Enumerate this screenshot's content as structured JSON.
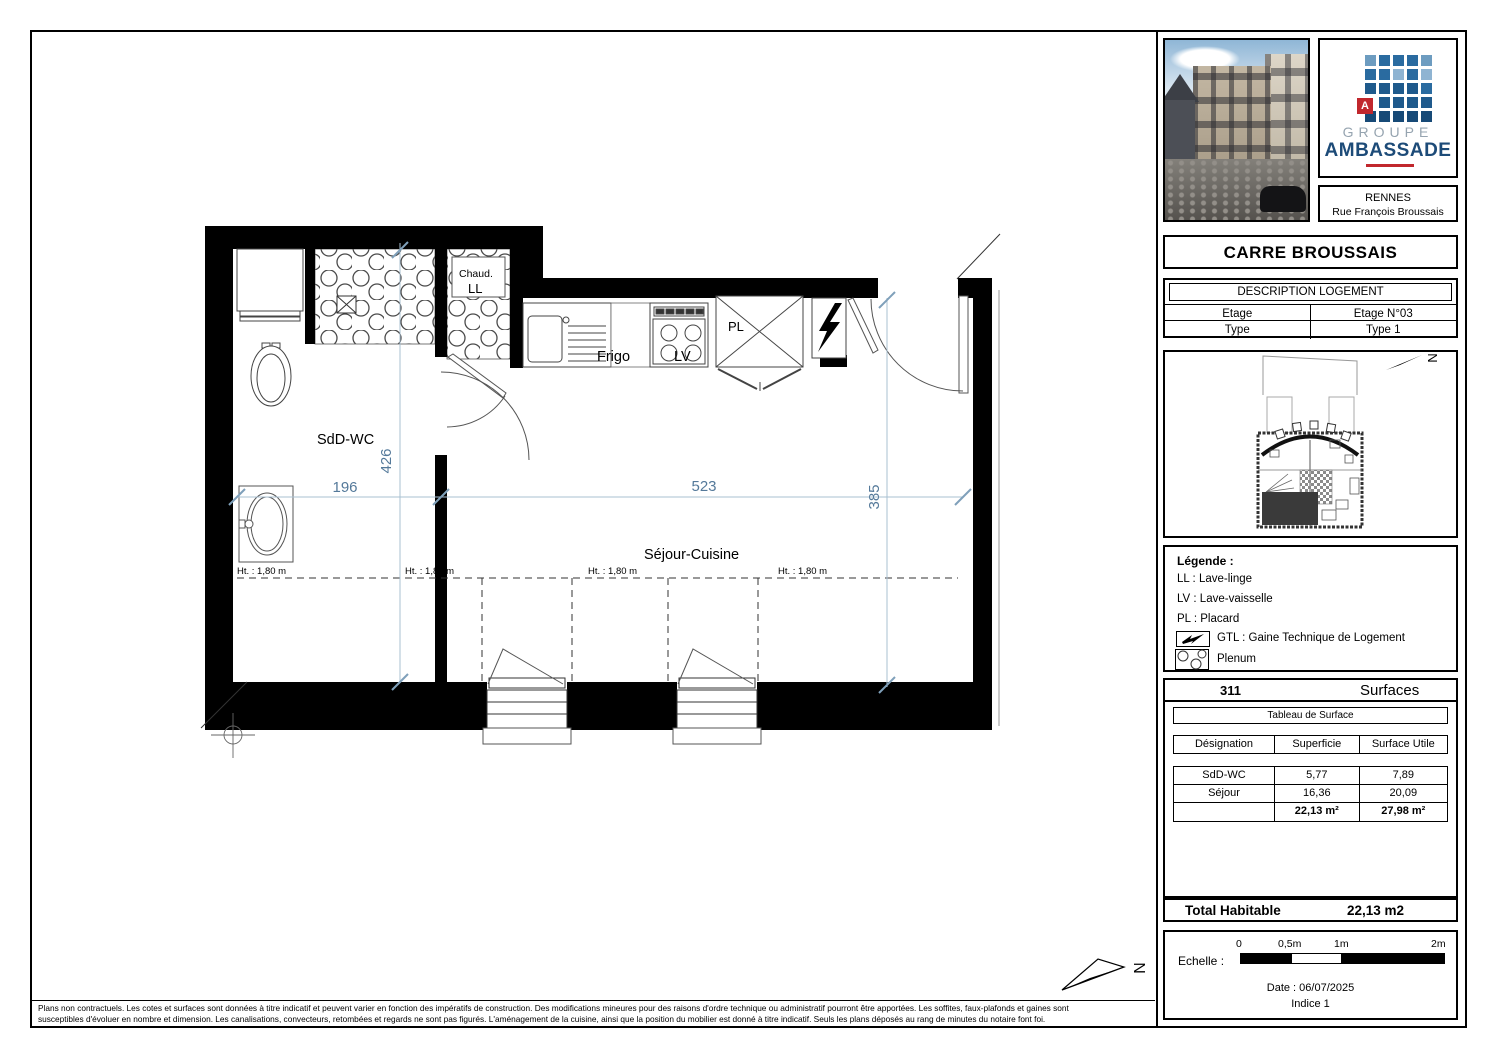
{
  "branding": {
    "logo_letter": "A",
    "logo_line1": "GROUPE",
    "logo_line2": "AMBASSADE",
    "city": "RENNES",
    "street": "Rue François Broussais"
  },
  "title": "CARRE BROUSSAIS",
  "description": {
    "header": "DESCRIPTION LOGEMENT",
    "rows": [
      {
        "label": "Etage",
        "value": "Etage N°03"
      },
      {
        "label": "Type",
        "value": "Type 1"
      }
    ]
  },
  "site_plan": {
    "north": "N"
  },
  "legend": {
    "title": "Légende :",
    "items": [
      "LL : Lave-linge",
      "LV : Lave-vaisselle",
      "PL : Placard"
    ],
    "gtl_label": "GTL : Gaine Technique de Logement",
    "plenum_label": "Plenum"
  },
  "surfaces": {
    "number": "311",
    "header": "Surfaces",
    "table_title": "Tableau de Surface",
    "columns": [
      "Désignation",
      "Superficie",
      "Surface Utile"
    ],
    "rows": [
      [
        "SdD-WC",
        "5,77",
        "7,89"
      ],
      [
        "Séjour",
        "16,36",
        "20,09"
      ]
    ],
    "totals": {
      "superficie": "22,13 m²",
      "utile": "27,98 m²"
    },
    "total_label": "Total Habitable",
    "total_value": "22,13 m2"
  },
  "scale_box": {
    "label": "Echelle :",
    "ticks": [
      "0",
      "0,5m",
      "1m",
      "2m"
    ],
    "date": "Date : 06/07/2025",
    "indice": "Indice 1"
  },
  "plan": {
    "room_sdd": "SdD-WC",
    "room_sejour": "Séjour-Cuisine",
    "chaud": "Chaud.",
    "ll": "LL",
    "frigo": "Frigo",
    "lv": "LV",
    "pl": "PL",
    "dim_196": "196",
    "dim_523": "523",
    "dim_426": "426",
    "dim_385": "385",
    "ht": "Ht. : 1,80 m",
    "north": "N"
  },
  "disclaimer": {
    "line1": "Plans non contractuels. Les cotes et surfaces sont données à titre indicatif et peuvent varier en fonction des impératifs de construction. Des modifications mineures pour des raisons d'ordre technique ou administratif pourront être apportées. Les soffites, faux-plafonds et gaines sont",
    "line2": "susceptibles d'évoluer en nombre et dimension. Les canalisations, convecteurs, retombées et regards ne sont pas figurés. L'aménagement de la cuisine, ainsi que la position du mobilier est donné à titre indicatif. Seuls les plans déposés au rang de minutes du notaire font foi."
  }
}
